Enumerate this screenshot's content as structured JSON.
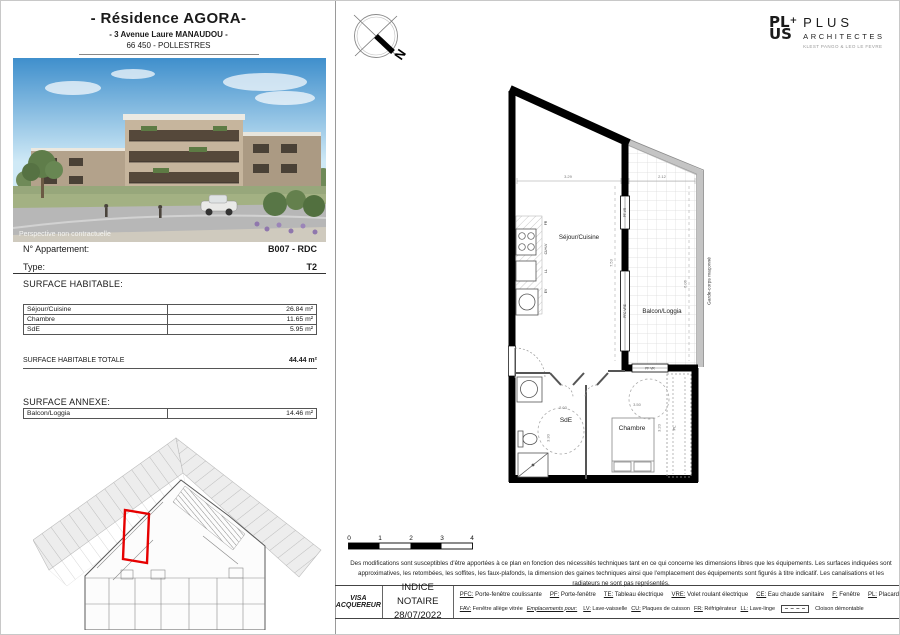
{
  "header": {
    "title": "- Résidence AGORA-",
    "address": "- 3 Avenue Laure MANAUDOU -",
    "city": "66 450 - POLLESTRES"
  },
  "photo": {
    "caption": "Perspective non contractuelle"
  },
  "apartment": {
    "number_label": "N° Appartement:",
    "number_value": "B007 - RDC",
    "type_label": "Type:",
    "type_value": "T2"
  },
  "surface_habitable": {
    "heading": "SURFACE HABITABLE:",
    "rows": [
      {
        "label": "Séjour/Cuisine",
        "value": "26.84 m²"
      },
      {
        "label": "Chambre",
        "value": "11.65 m²"
      },
      {
        "label": "SdE",
        "value": "5.95 m²"
      }
    ],
    "total_label": "SURFACE HABITABLE TOTALE",
    "total_value": "44.44 m²"
  },
  "surface_annexe": {
    "heading": "SURFACE ANNEXE:",
    "rows": [
      {
        "label": "Balcon/Loggia",
        "value": "14.46 m²"
      }
    ]
  },
  "logo": {
    "block_line1": "PL",
    "block_plus": "+",
    "block_line2": "US",
    "name": "PLUS",
    "subtitle": "ARCHITECTES",
    "tagline": "KLEST PANGO & LEO LE FEVRE"
  },
  "compass": {
    "north": "N"
  },
  "floor_plan": {
    "rooms": {
      "sejour": "Séjour/Cuisine",
      "balcon": "Balcon/Loggia",
      "sde": "SdE",
      "chambre": "Chambre"
    },
    "dims": {
      "sejour_w": "3.29",
      "balcon_w": "2.12",
      "sejour_h": "7.53",
      "balcon_h": "6.06",
      "sde_w": "2.03",
      "sde_h": "3.30",
      "chambre_w": "3.50",
      "chambre_h": "3.20"
    },
    "garde_corps": "Garde-corps maçonné",
    "windows": {
      "small": "PF VR",
      "large": "PFC VRE",
      "chambre": "PF VR"
    },
    "kitchen_labels": [
      "FR",
      "CU+LV",
      "LL",
      "EV"
    ],
    "placard": "PL"
  },
  "scale_bar": {
    "ticks": [
      "0",
      "1",
      "2",
      "3",
      "4"
    ]
  },
  "disclaimer": {
    "text": "Des modifications sont susceptibles d'être apportées à ce plan en fonction des nécessités techniques tant en ce qui concerne les dimensions libres que les équipements. Les surfaces indiquées sont approximatives, les retombées, les soffites, les faux-plafonds, la dimension des gaines techniques ainsi que l'emplacement des équipements sont figurés à titre indicatif. Les canalisations et les radiateurs ne sont pas représentés."
  },
  "footer": {
    "visa": "VISA ACQUEREUR",
    "indice_label": "INDICE NOTAIRE",
    "indice_date": "28/07/2022",
    "legend1": [
      {
        "abbr": "PFC:",
        "desc": "Porte-fenêtre coulissante"
      },
      {
        "abbr": "PF:",
        "desc": "Porte-fenêtre"
      },
      {
        "abbr": "TE:",
        "desc": "Tableau électrique"
      },
      {
        "abbr": "VRE:",
        "desc": "Volet roulant électrique"
      },
      {
        "abbr": "CE:",
        "desc": "Eau chaude sanitaire"
      },
      {
        "abbr": "F:",
        "desc": "Fenêtre"
      },
      {
        "abbr": "PL:",
        "desc": "Placard"
      }
    ],
    "legend2_fav": {
      "abbr": "FAV:",
      "desc": "Fenêtre allège vitrée"
    },
    "legend2_emplacements": "Emplacements pour:",
    "legend2": [
      {
        "abbr": "LV:",
        "desc": "Lave-vaisselle"
      },
      {
        "abbr": "CU:",
        "desc": "Plaques de cuisson"
      },
      {
        "abbr": "FR:",
        "desc": "Réfrigérateur"
      },
      {
        "abbr": "LL:",
        "desc": "Lave-linge"
      }
    ],
    "cloison": "Cloison démontable"
  },
  "colors": {
    "accent_red": "#e60000",
    "wall_black": "#000000",
    "balcony_gray": "#c4c4c4"
  }
}
